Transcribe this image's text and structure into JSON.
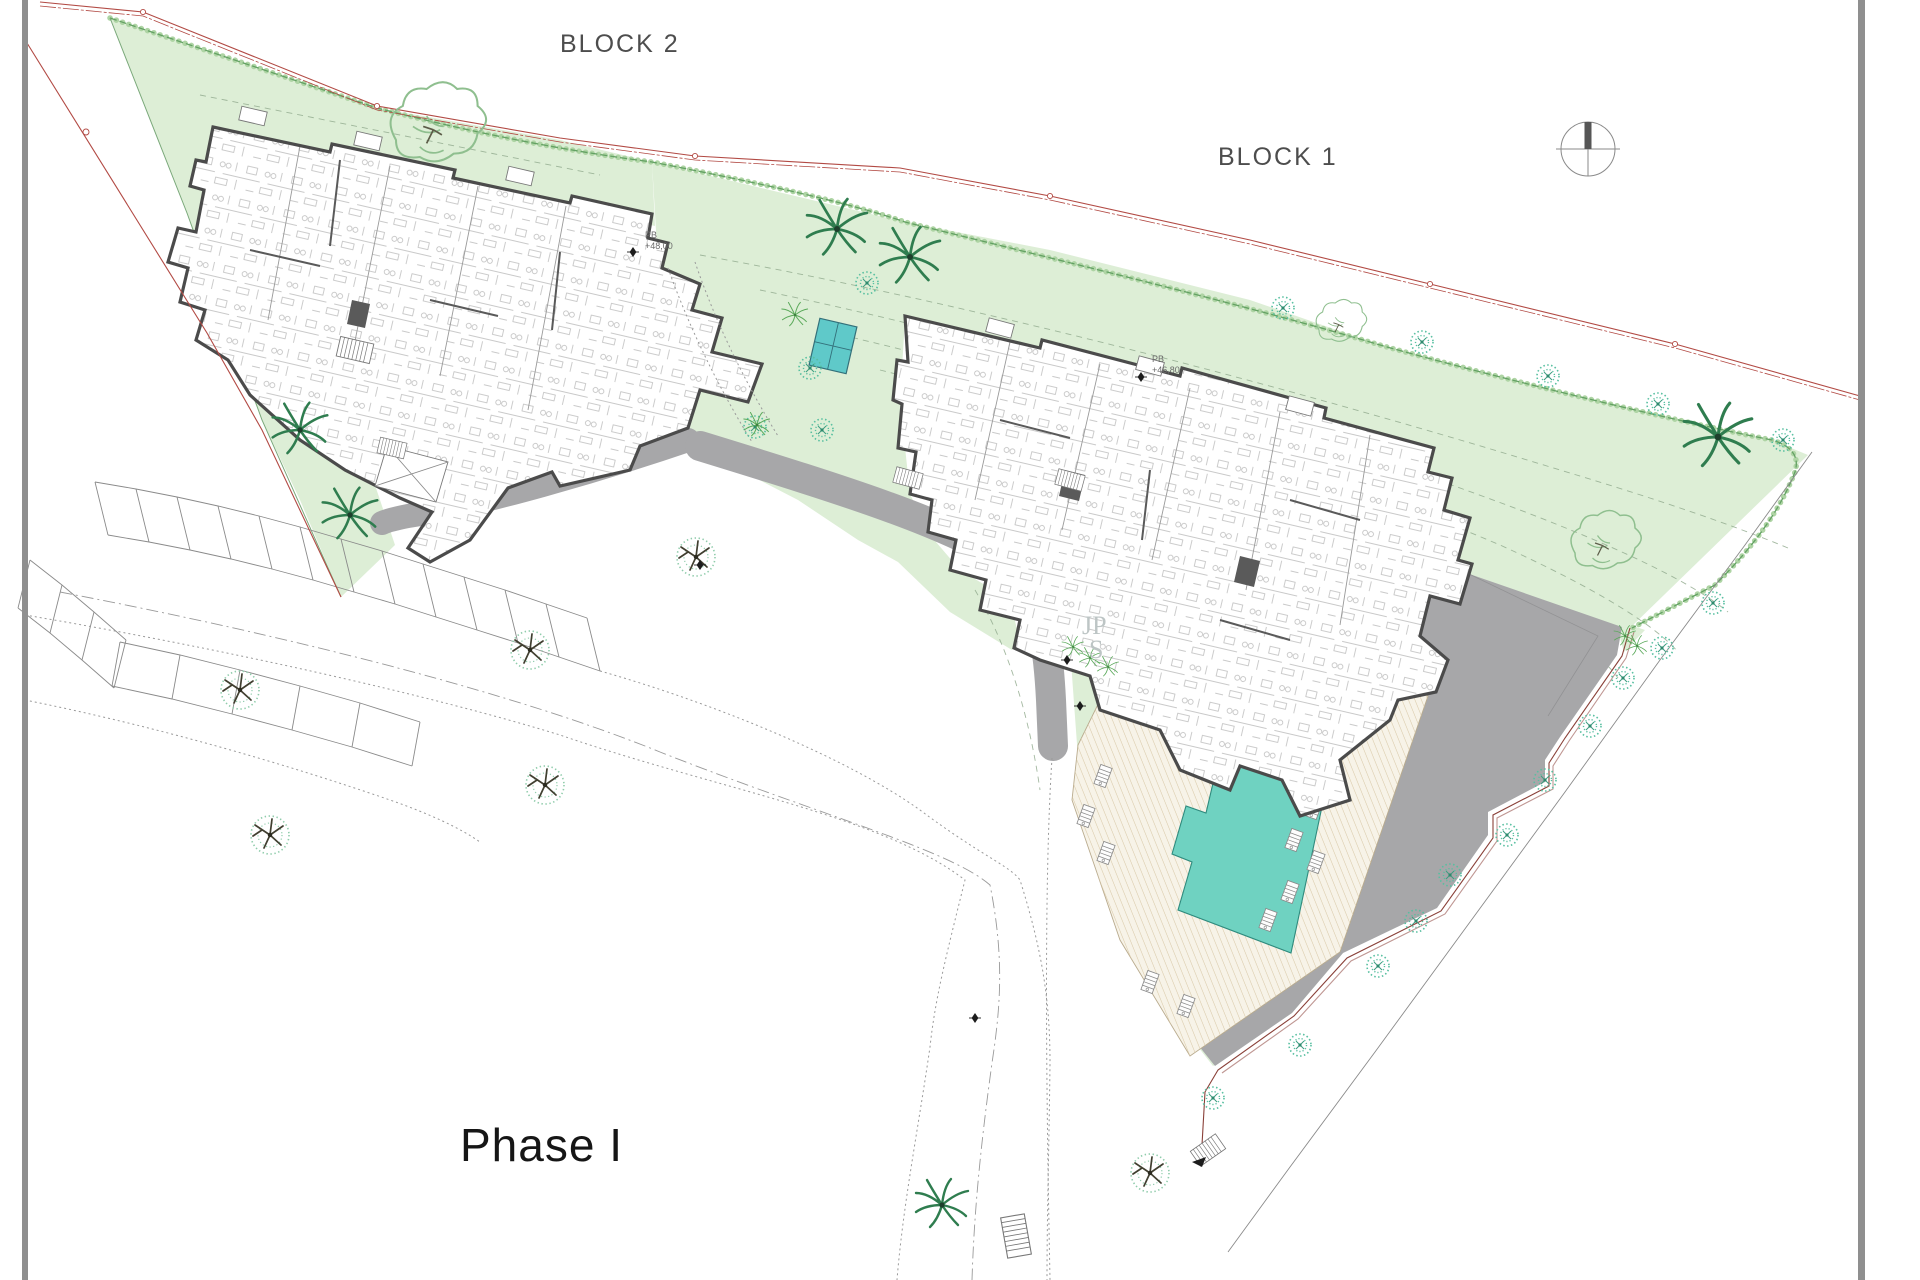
{
  "labels": {
    "block1": "BLOCK 1",
    "block2": "BLOCK 2",
    "phase": "Phase I"
  },
  "level_markers": {
    "block2_floor": {
      "prefix": "PB",
      "value": "+48,00"
    },
    "block1_floor": {
      "prefix": "PB",
      "value": "+46,80"
    }
  },
  "watermark": {
    "line1": "JP",
    "line2": "S"
  },
  "icons": {
    "north_compass": "north-compass-icon",
    "palm_tree": "palm-tree-icon",
    "round_tree": "round-tree-icon",
    "branched_tree": "branched-tree-icon"
  },
  "colors": {
    "bg": "#ffffff",
    "green": "#ddeed6",
    "green-edge": "#7aa87a",
    "hedge": "#63a163",
    "hedge-light": "#aed4a4",
    "contour": "#93ac8f",
    "road": "#a7a7a9",
    "pool": "#6fd2c1",
    "wall": "#4b4b4b",
    "red": "#b24a44",
    "tree-teal": "#57bfa0",
    "palm": "#2f7d4f",
    "label": "#4d4d4d",
    "watermark": "#bdc5c5"
  }
}
